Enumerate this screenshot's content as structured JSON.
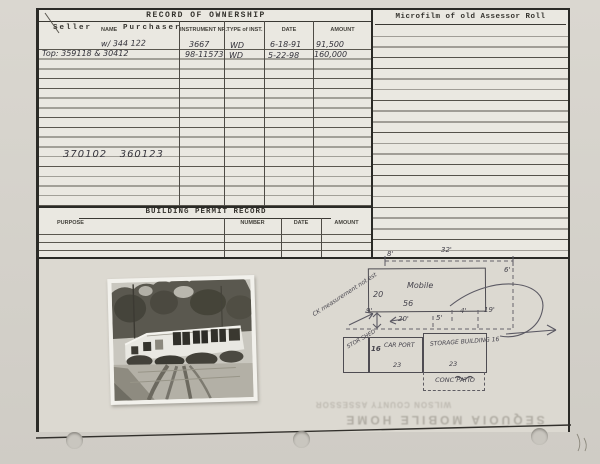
{
  "ownership": {
    "title": "RECORD OF OWNERSHIP",
    "seller": "Seller",
    "name_label": "NAME",
    "purchaser": "Purchaser",
    "instrument_nr": "INSTRUMENT NR.",
    "type_of_inst": "TYPE of INST.",
    "date": "DATE",
    "amount": "AMOUNT",
    "rows": [
      {
        "party": "w/ 344 122",
        "instrument": "3667",
        "type": "WD",
        "date": "6-18-91",
        "amount": "91,500"
      },
      {
        "party": "Top: 359118 & 30412",
        "instrument": "98-11573",
        "type": "WD",
        "date": "5-22-98",
        "amount": "160,000"
      }
    ],
    "parcel_numbers": "370102   360123"
  },
  "permit": {
    "title": "BUILDING PERMIT RECORD",
    "headers": [
      "PURPOSE",
      "NUMBER",
      "DATE",
      "AMOUNT"
    ]
  },
  "microfilm": {
    "title": "Microfilm of old Assessor Roll"
  },
  "sketch": {
    "mobile": "Mobile",
    "width_20": "20",
    "length_56": "56",
    "dim_8": "8'",
    "dim_32": "32'",
    "dim_6": "6'",
    "dim_9": "9'",
    "dim_20": "20'",
    "dim_5": "5'",
    "dim_4": "4'",
    "dim_19": "19'",
    "check_note": "CK\nmeasurement\nnot est",
    "shed": "STOR\nSHED",
    "carport_16": "16",
    "carport": "CAR\nPORT",
    "carport_23": "23",
    "storage": "STORAGE\nBUILDING 16",
    "storage_23": "23",
    "patio": "CONC PATIO"
  },
  "bleedthrough": {
    "line1": "SEQUOIA MOBILE HOME",
    "line2": "WILSON COUNTY ASSESSOR"
  },
  "photo": {
    "alt": "black and white photograph of a single-wide mobile home with shuttered windows, trees behind and a dirt driveway in front"
  }
}
